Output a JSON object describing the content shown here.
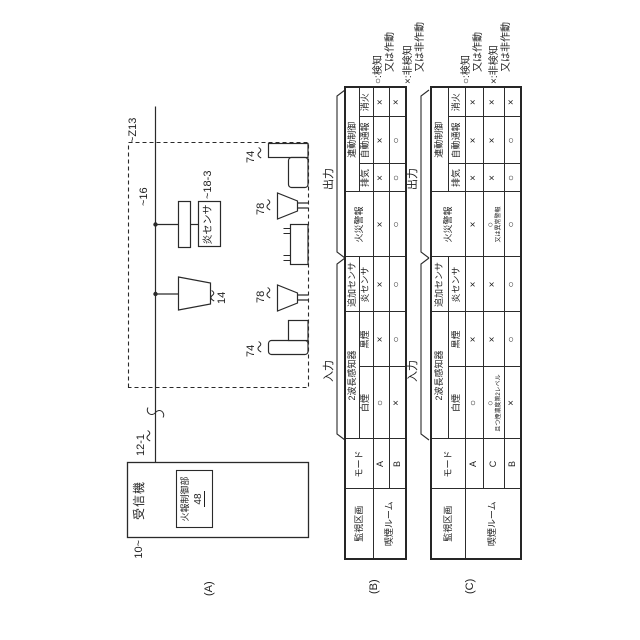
{
  "panel_a": {
    "label": "(A)",
    "receiver_ref": "10~",
    "receiver_title": "受信機",
    "controller_title": "火報制御部",
    "controller_ref": "48",
    "line_ref": "12-1",
    "zone_ref": "~Z13",
    "detector_ref": "14",
    "base_ref": "~16",
    "flame_sensor_label": "炎センサ",
    "flame_sensor_ref": "~18-3",
    "speaker_ref_left": "74",
    "speaker_ref_right": "74",
    "nozzle_ref_left": "78",
    "nozzle_ref_right": "78"
  },
  "group_labels": {
    "input": "入力",
    "output": "出力"
  },
  "headers": {
    "zone": "監視区画",
    "mode": "モード",
    "detector2wl": "2波長感知器",
    "white": "白煙",
    "black": "黒煙",
    "added_sensor": "追加センサ",
    "flame": "炎センサ",
    "fire_alarm": "火災警報",
    "interlock": "連動制御",
    "exhaust": "排気",
    "auto_report": "自動通報",
    "extinguish": "消火"
  },
  "legend": {
    "detect_line1": "○:検知",
    "detect_line2": "又は作動",
    "nondetect_line1": "×:非検知",
    "nondetect_line2": "又は非作動"
  },
  "table_b": {
    "label": "(B)",
    "zone": "喫煙ルーム",
    "rows": [
      {
        "mode": "A",
        "white": "○",
        "black": "×",
        "flame": "×",
        "fire_alarm": "×",
        "exhaust": "×",
        "auto_report": "×",
        "extinguish": "×"
      },
      {
        "mode": "B",
        "white": "×",
        "black": "○",
        "flame": "○",
        "fire_alarm": "○",
        "exhaust": "○",
        "auto_report": "○",
        "extinguish": "×"
      }
    ]
  },
  "table_c": {
    "label": "(C)",
    "zone": "喫煙ルーム",
    "rows": [
      {
        "mode": "A",
        "white": "○",
        "black": "×",
        "flame": "×",
        "fire_alarm": "×",
        "exhaust": "×",
        "auto_report": "×",
        "extinguish": "×"
      },
      {
        "mode": "C",
        "white": "○",
        "white_note": "且つ煙濃度第2レベル",
        "black": "×",
        "flame": "×",
        "fire_alarm": "○",
        "fire_alarm_note": "又は異常警報",
        "exhaust": "×",
        "auto_report": "×",
        "extinguish": "×"
      },
      {
        "mode": "B",
        "white": "×",
        "black": "○",
        "flame": "○",
        "fire_alarm": "○",
        "exhaust": "○",
        "auto_report": "○",
        "extinguish": "×"
      }
    ]
  },
  "colors": {
    "ink": "#2a2a2a",
    "background": "#ffffff"
  }
}
